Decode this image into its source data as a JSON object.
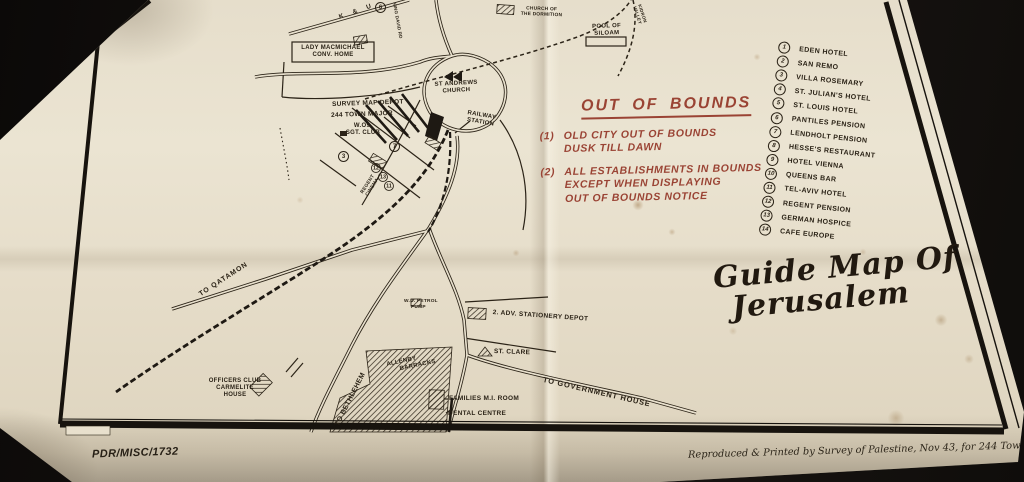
{
  "colors": {
    "paper": "#e6decb",
    "ink": "#2b2317",
    "out_of_bounds_red": "#9a4334",
    "background": "#17130f"
  },
  "title": {
    "line1": "Guide Map Of",
    "line2": "Jerusalem"
  },
  "out_of_bounds": {
    "title": "OUT OF BOUNDS",
    "item1_num": "(1)",
    "item1_line1": "OLD CITY OUT OF BOUNDS",
    "item1_line2": "DUSK TILL DAWN",
    "item2_num": "(2)",
    "item2_line1": "ALL ESTABLISHMENTS IN BOUNDS",
    "item2_line2": "EXCEPT WHEN DISPLAYING",
    "item2_line3": "OUT OF BOUNDS NOTICE"
  },
  "legend": {
    "items": [
      {
        "num": "1",
        "label": "EDEN HOTEL"
      },
      {
        "num": "2",
        "label": "SAN REMO"
      },
      {
        "num": "3",
        "label": "VILLA ROSEMARY"
      },
      {
        "num": "4",
        "label": "ST. JULIAN'S HOTEL"
      },
      {
        "num": "5",
        "label": "ST. LOUIS HOTEL"
      },
      {
        "num": "6",
        "label": "PANTILES PENSION"
      },
      {
        "num": "7",
        "label": "LENDHOLT PENSION"
      },
      {
        "num": "8",
        "label": "HESSE'S RESTAURANT"
      },
      {
        "num": "9",
        "label": "HOTEL VIENNA"
      },
      {
        "num": "10",
        "label": "QUEENS BAR"
      },
      {
        "num": "11",
        "label": "TEL-AVIV HOTEL"
      },
      {
        "num": "12",
        "label": "REGENT PENSION"
      },
      {
        "num": "13",
        "label": "GERMAN HOSPICE"
      },
      {
        "num": "14",
        "label": "CAFE EUROPE"
      }
    ]
  },
  "map_labels": {
    "lady_macmichael": {
      "lines": [
        "LADY MACMICHAEL",
        "CONV. HOME"
      ]
    },
    "survey_map_depot": {
      "text": "SURVEY MAP DEPOT"
    },
    "town_major": {
      "text": "244 TOWN MAJOR"
    },
    "wo_sgt_club": {
      "lines": [
        "W.Os.",
        "SGT. CLUB"
      ]
    },
    "st_andrews_church": {
      "lines": [
        "ST ANDREWS",
        "CHURCH"
      ]
    },
    "railway_station": {
      "lines": [
        "RAILWAY",
        "STATION"
      ]
    },
    "pool_of_siloam": {
      "lines": [
        "POOL OF",
        "SILOAM"
      ]
    },
    "church_dormition": {
      "lines": [
        "CHURCH OF",
        "THE DORMITION"
      ]
    },
    "kidron_valley": {
      "lines": [
        "KIDRON",
        "VALLEY"
      ]
    },
    "regent_cinema": {
      "lines": [
        "REGENT",
        "CINEMA"
      ]
    },
    "to_qatamon": {
      "text": "TO QATAMON"
    },
    "to_bethlehem": {
      "text": "TO BETHLEHEM"
    },
    "to_government_house": {
      "text": "TO GOVERNMENT HOUSE"
    },
    "allenby_barracks": {
      "lines": [
        "ALLENBY",
        "BARRACKS"
      ]
    },
    "officers_club": {
      "lines": [
        "OFFICERS CLUB",
        "CARMELITE",
        "HOUSE"
      ]
    },
    "families_mi_room": {
      "text": "FAMILIES M.I. ROOM"
    },
    "dental_centre": {
      "text": "DENTAL CENTRE"
    },
    "st_clare": {
      "text": "ST. CLARE"
    },
    "wd_petrol_pump": {
      "lines": [
        "W.D. PETROL",
        "PUMP"
      ]
    },
    "stationery_depot": {
      "text": "2. ADV. STATIONERY DEPOT"
    },
    "king_david_rd": {
      "text": "KING DAVID RD"
    },
    "road_letters": {
      "text": "K & U"
    }
  },
  "map_numbers": {
    "n3": "3",
    "n6": "6",
    "n7": "7",
    "n11": "11",
    "n12": "12",
    "n13": "13"
  },
  "footer": {
    "reference": "PDR/MISC/1732",
    "credit": "Reproduced & Printed by Survey of Palestine, Nov 43, for 244 Town Major, M.E.F."
  }
}
